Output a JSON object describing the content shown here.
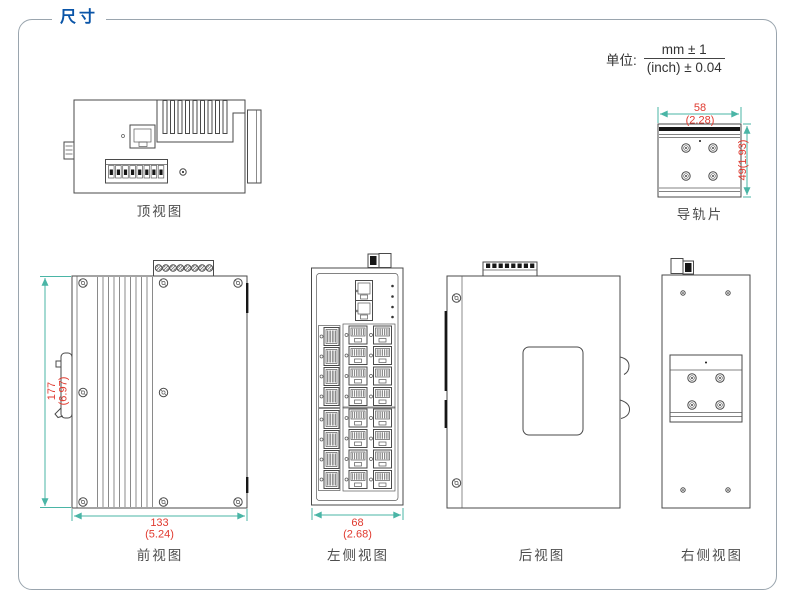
{
  "header": {
    "title": "尺寸",
    "unit_label": "单位:",
    "unit_mm": "mm ± 1",
    "unit_inch": "(inch) ± 0.04"
  },
  "views": {
    "top_view": {
      "label": "顶视图"
    },
    "rail": {
      "label": "导轨片",
      "width_mm": "58",
      "width_inch": "(2.28)",
      "height_dim": "49(1.93)"
    },
    "front_view": {
      "label": "前视图",
      "height_mm": "177",
      "height_inch": "(6.97)",
      "width_mm": "133",
      "width_inch": "(5.24)"
    },
    "left_view": {
      "label": "左侧视图",
      "width_mm": "68",
      "width_inch": "(2.68)"
    },
    "back_view": {
      "label": "后视图"
    },
    "right_view": {
      "label": "右侧视图"
    }
  },
  "colors": {
    "accent_blue": "#0a55a8",
    "dimension_line": "#4ab5a6",
    "dimension_text": "#e03a2f",
    "drawing_outline": "#4a4a4a",
    "label_text": "#4d4d4d",
    "border": "#9aa5ae"
  }
}
